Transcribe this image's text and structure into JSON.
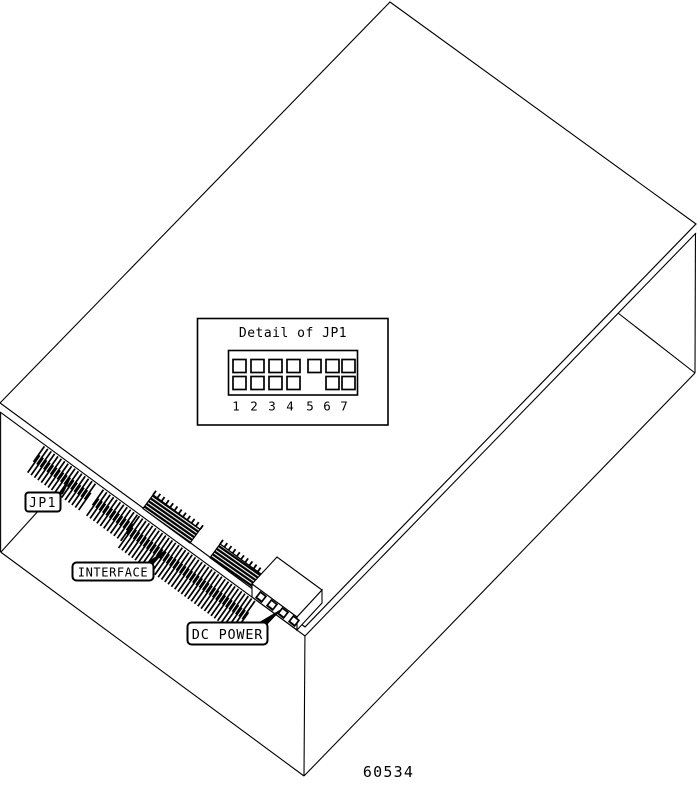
{
  "figure": {
    "caption": "60534",
    "background": "#ffffff",
    "line_color": "#000000"
  },
  "inset": {
    "title": "Detail of JP1",
    "pin_labels": [
      "1",
      "2",
      "3",
      "4",
      "5",
      "6",
      "7"
    ],
    "pin_rows": {
      "top": [
        true,
        true,
        true,
        true,
        true,
        true,
        true
      ],
      "bottom": [
        true,
        true,
        true,
        true,
        false,
        true,
        true
      ]
    }
  },
  "callouts": {
    "jp1_label": "JP1",
    "interface_label": "INTERFACE",
    "dc_power_label": "DC POWER"
  }
}
